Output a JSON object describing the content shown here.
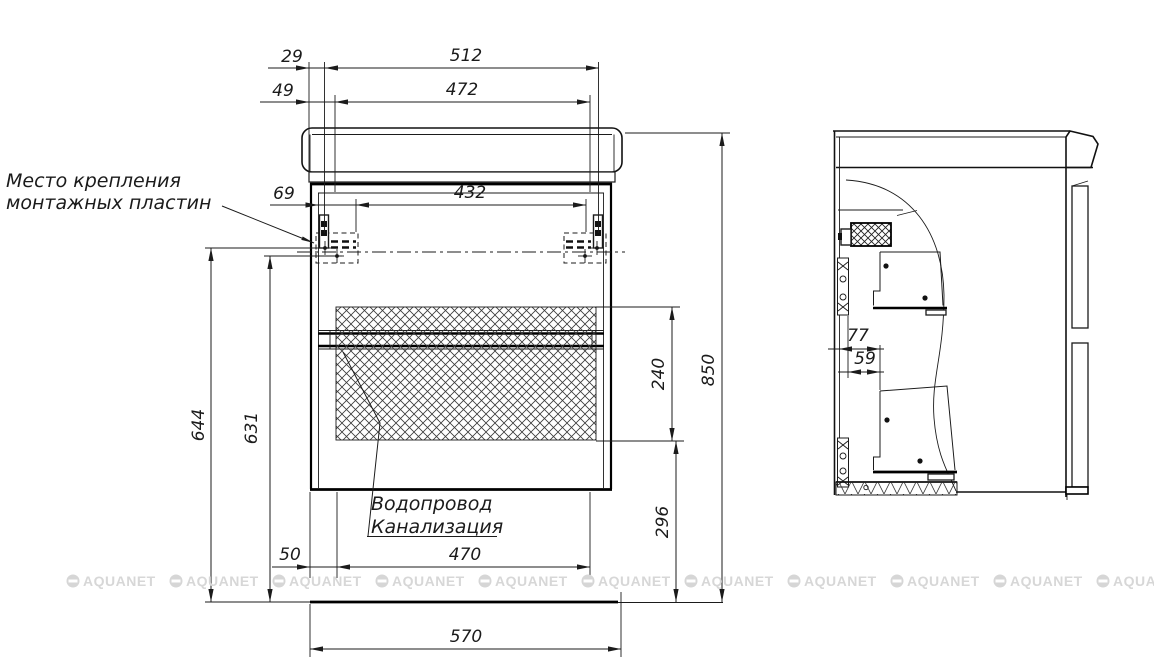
{
  "drawing": {
    "type": "technical-drawing",
    "annotations": {
      "mounting_plates": {
        "line1": "Место крепления",
        "line2": "монтажных пластин"
      },
      "plumbing": {
        "line1": "Водопровод",
        "line2": "Канализация"
      }
    },
    "dimensions_mm": {
      "d29": "29",
      "d512": "512",
      "d49": "49",
      "d472": "472",
      "d69": "69",
      "d432": "432",
      "d644": "644",
      "d631": "631",
      "d240": "240",
      "d850": "850",
      "d296": "296",
      "d50": "50",
      "d470": "470",
      "d570": "570",
      "d77": "77",
      "d59": "59"
    },
    "watermark": {
      "label": "AQUANET"
    },
    "colors": {
      "line": "#1b1b1b",
      "hatch": "#3a3a3a",
      "watermark": "#d7d7d7",
      "background": "#ffffff"
    }
  }
}
